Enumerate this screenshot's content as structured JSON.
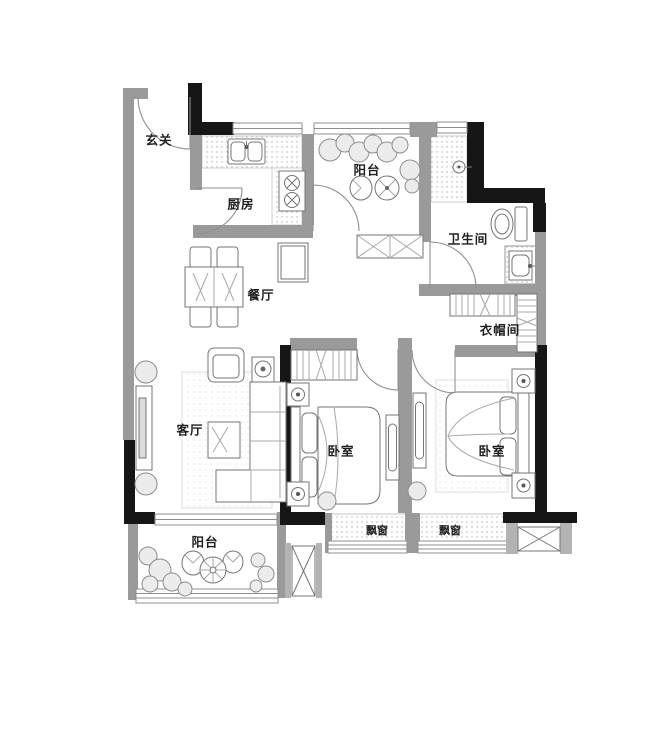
{
  "title": "三室两厅户型图",
  "colors": {
    "wall-gray": "#9a9a9a",
    "wall-black": "#161616",
    "furniture-line": "#757575",
    "text": "#1f1f1f",
    "bg": "#ffffff"
  },
  "rooms": [
    {
      "id": "entry",
      "label": "玄关"
    },
    {
      "id": "kitchen",
      "label": "厨房"
    },
    {
      "id": "balcony-top",
      "label": "阳台"
    },
    {
      "id": "bathroom",
      "label": "卫生间"
    },
    {
      "id": "dining",
      "label": "餐厅"
    },
    {
      "id": "cloakroom",
      "label": "衣帽间"
    },
    {
      "id": "living",
      "label": "客厅"
    },
    {
      "id": "bedroom-1",
      "label": "卧室"
    },
    {
      "id": "bedroom-2",
      "label": "卧室"
    },
    {
      "id": "balcony-bottom",
      "label": "阳台"
    },
    {
      "id": "baywindow-1",
      "label": "飘窗"
    },
    {
      "id": "baywindow-2",
      "label": "飘窗"
    }
  ]
}
